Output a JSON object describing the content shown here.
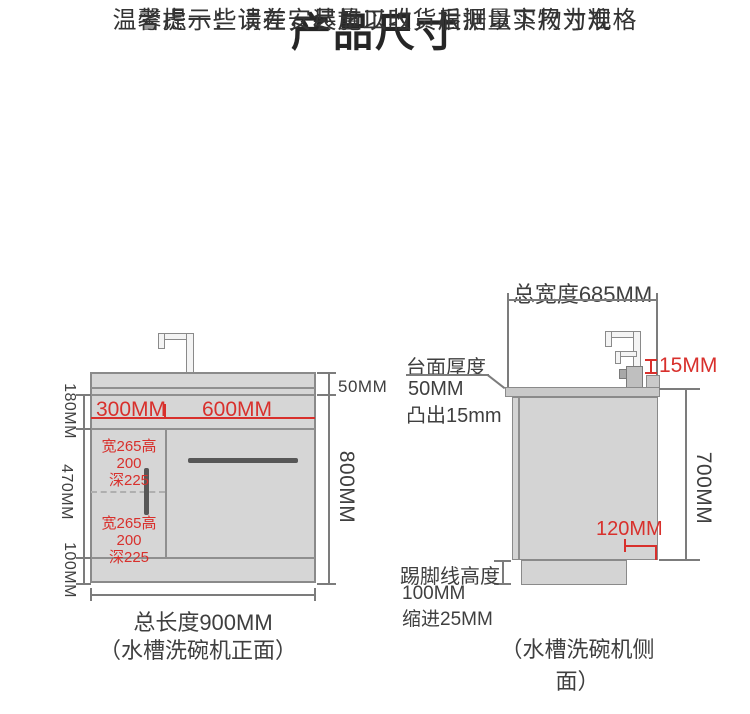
{
  "title": "产品尺寸",
  "subtitle": {
    "line1": "温馨提示：请在安装施工时，根据以下尺寸规格",
    "line2": "考虑一些误差，尽量以收货后测量实物为准"
  },
  "front_view": {
    "caption": "（水槽洗碗机正面）",
    "total_length": "总长度900MM",
    "overall_height": "800MM",
    "counter_thickness": "50MM",
    "sink_zone_height": "180MM",
    "cabinet_zone_height": "470MM",
    "toekick_height": "100MM",
    "left_sink_width": "300MM",
    "right_sink_width": "600MM",
    "basin_top": {
      "line1": "宽265高200",
      "line2": "深225"
    },
    "basin_bottom": {
      "line1": "宽265高200",
      "line2": "深225"
    }
  },
  "side_view": {
    "caption": "（水槽洗碗机侧面）",
    "total_width": "总宽度685MM",
    "counter_note": {
      "line1": "台面厚度",
      "line2": "50MM",
      "line3": "凸出15mm"
    },
    "protrusion": "15MM",
    "body_height": "700MM",
    "bottom_inset": "120MM",
    "toekick_note": {
      "line1": "踢脚线高度",
      "line2": "100MM",
      "line3": "缩进25MM"
    }
  },
  "colors": {
    "dimension_red": "#d8302c",
    "cabinet_fill": "#d6d6d6",
    "line_gray": "#8a8a8a",
    "text_dark": "#3f3f3f"
  }
}
